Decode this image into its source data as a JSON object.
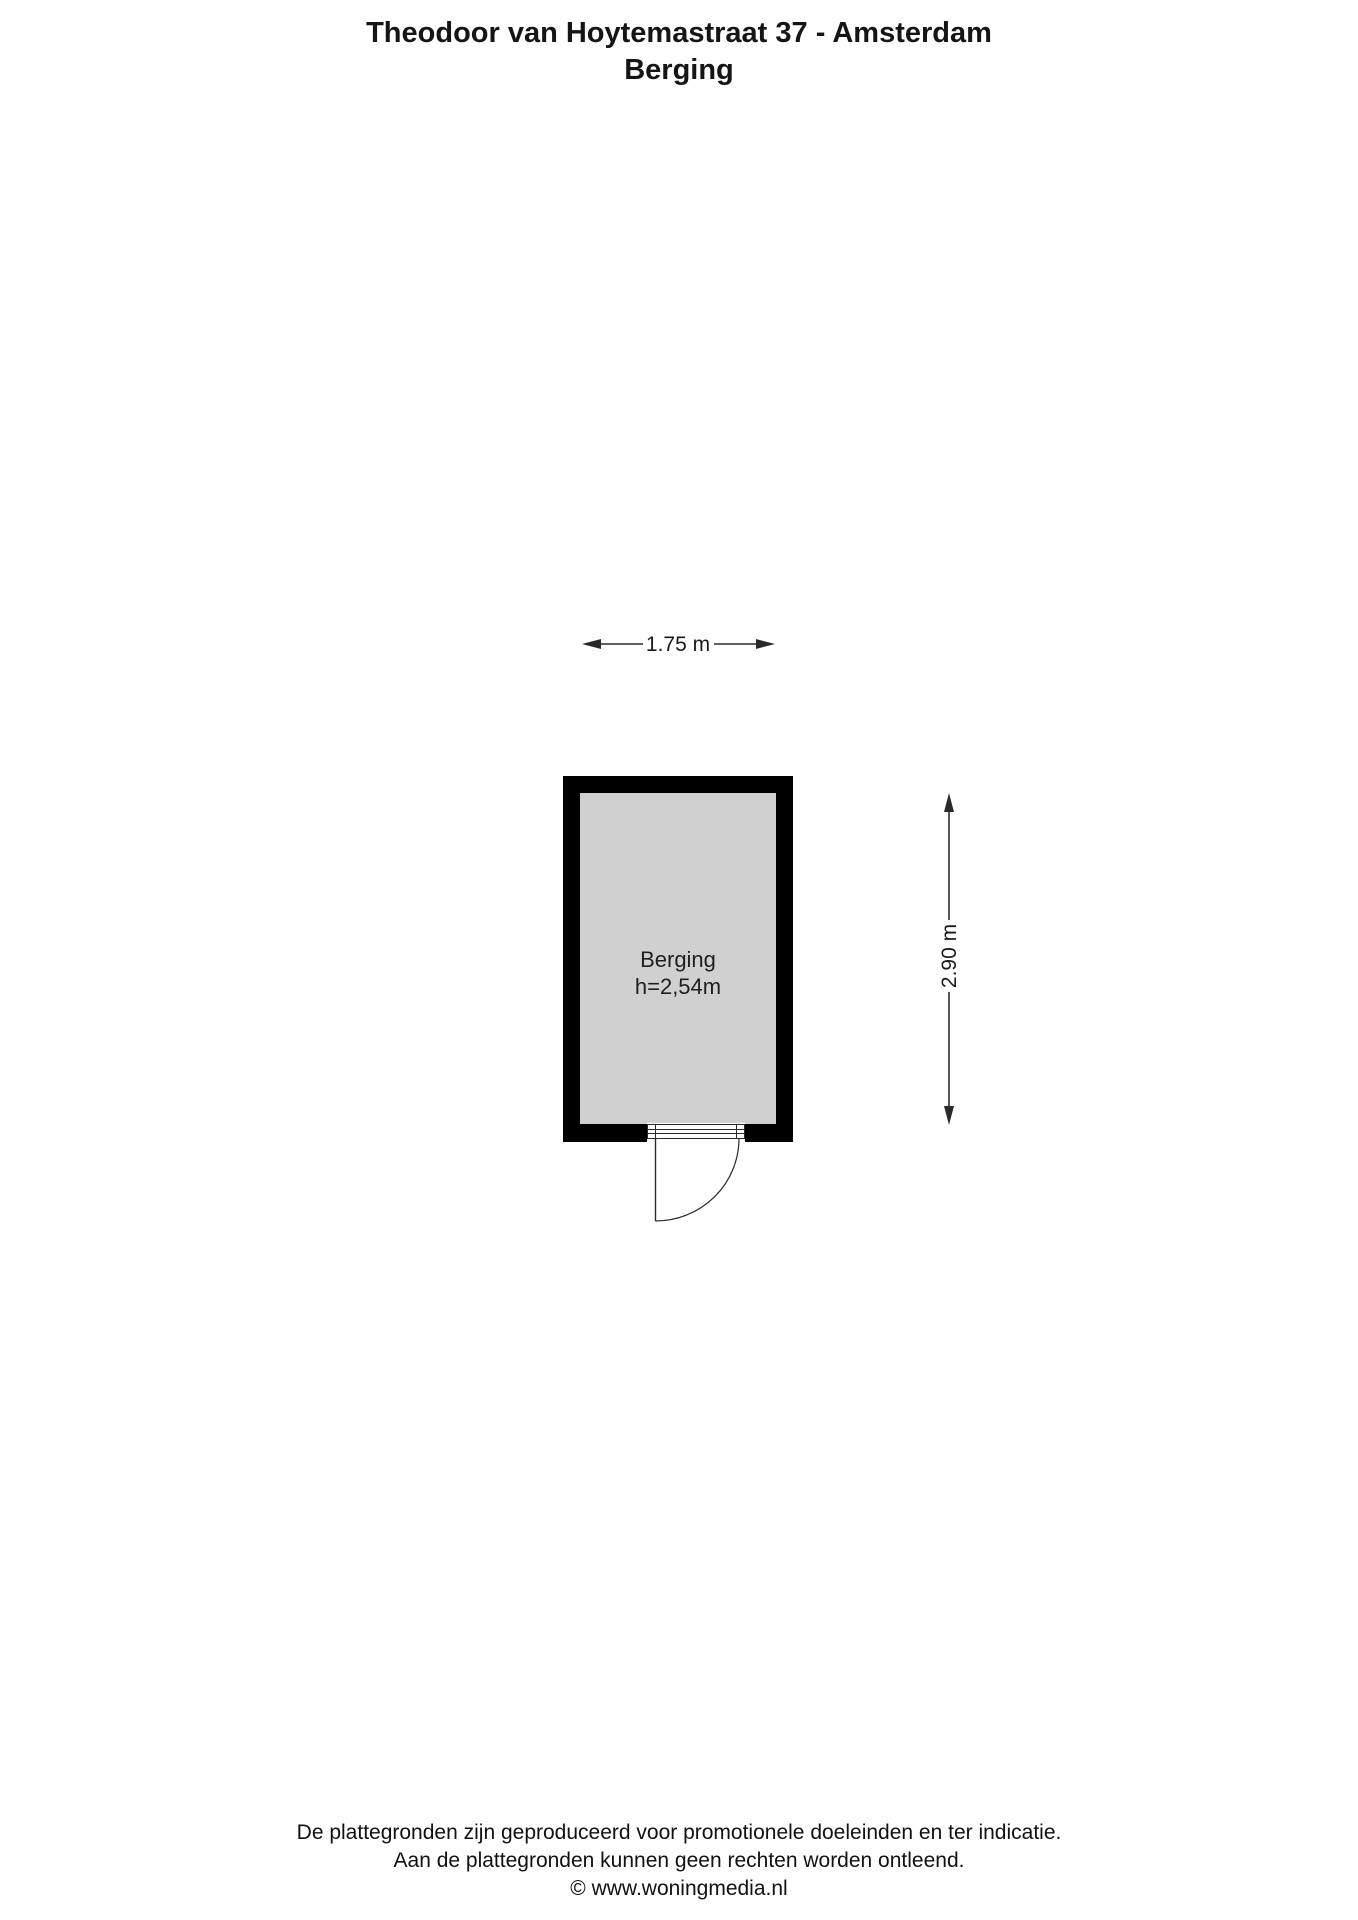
{
  "page": {
    "title_line1": "Theodoor van Hoytemastraat 37 - Amsterdam",
    "title_line2": "Berging"
  },
  "floor_plan": {
    "room": {
      "name": "Berging",
      "ceiling_height": "h=2,54m"
    },
    "dimensions": {
      "width_label": "1.75 m",
      "height_label": "2.90 m"
    },
    "colors": {
      "wall": "#000000",
      "floor": "#d0d0d0",
      "line": "#2a2a2a"
    }
  },
  "footer": {
    "line1": "De plattegronden zijn geproduceerd voor promotionele doeleinden en ter indicatie.",
    "line2": "Aan de plattegronden kunnen geen rechten worden ontleend.",
    "copyright": "© www.woningmedia.nl"
  }
}
